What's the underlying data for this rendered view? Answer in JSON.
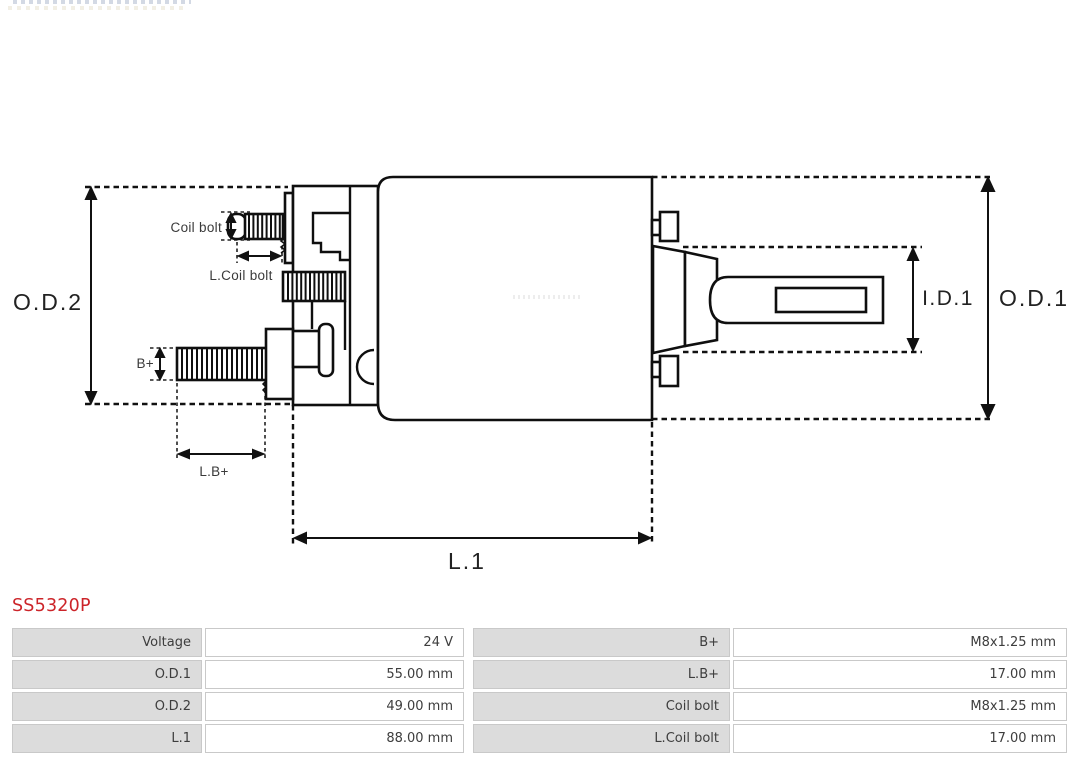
{
  "part_number": "SS5320P",
  "accent_color": "#cc2429",
  "diagram": {
    "labels": {
      "od2": "O.D.2",
      "od1": "O.D.1",
      "id1": "I.D.1",
      "l1": "L.1",
      "coil_bolt": "Coil bolt",
      "l_coil_bolt": "L.Coil bolt",
      "b_plus": "B+",
      "l_b_plus": "L.B+"
    }
  },
  "spec_table": {
    "left": [
      {
        "label": "Voltage",
        "value": "24 V"
      },
      {
        "label": "O.D.1",
        "value": "55.00 mm"
      },
      {
        "label": "O.D.2",
        "value": "49.00 mm"
      },
      {
        "label": "L.1",
        "value": "88.00 mm"
      }
    ],
    "right": [
      {
        "label": "B+",
        "value": "M8x1.25 mm"
      },
      {
        "label": "L.B+",
        "value": "17.00 mm"
      },
      {
        "label": "Coil bolt",
        "value": "M8x1.25 mm"
      },
      {
        "label": "L.Coil bolt",
        "value": "17.00 mm"
      }
    ]
  }
}
